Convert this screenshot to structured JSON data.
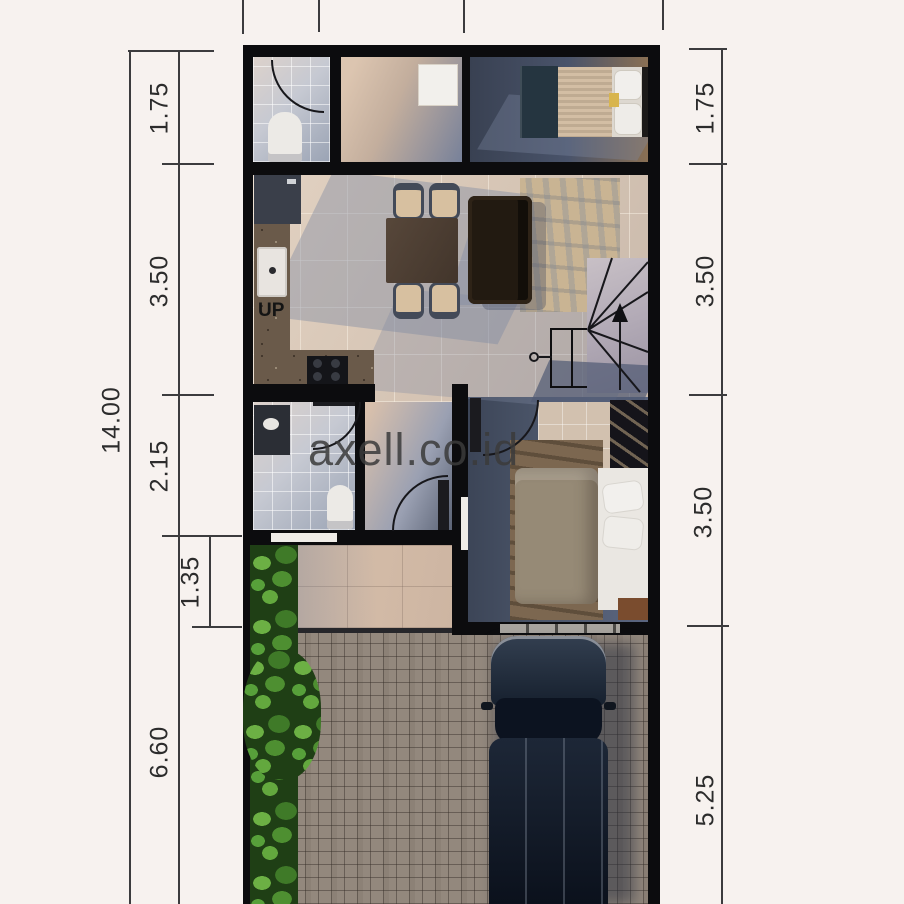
{
  "watermark": {
    "text": "axell.co.id"
  },
  "plan": {
    "up_label": "UP"
  },
  "dimensions": {
    "overall": "14.00",
    "left": [
      "1.75",
      "3.50",
      "2.15",
      "1.35",
      "6.60"
    ],
    "right": [
      "1.75",
      "3.50",
      "3.50",
      "5.25"
    ]
  },
  "colors": {
    "wall": "#0c0c0e",
    "dimension_text": "#2c2c2c",
    "watermark_text": "#3b3b3b",
    "floor_beige": "#d5c4b4",
    "floor_slate": "#4b5569",
    "bath_tile": "#c6c9d2",
    "paver": "#93887d",
    "hedge_green": "#4e8f31",
    "car_body": "#17202e"
  }
}
